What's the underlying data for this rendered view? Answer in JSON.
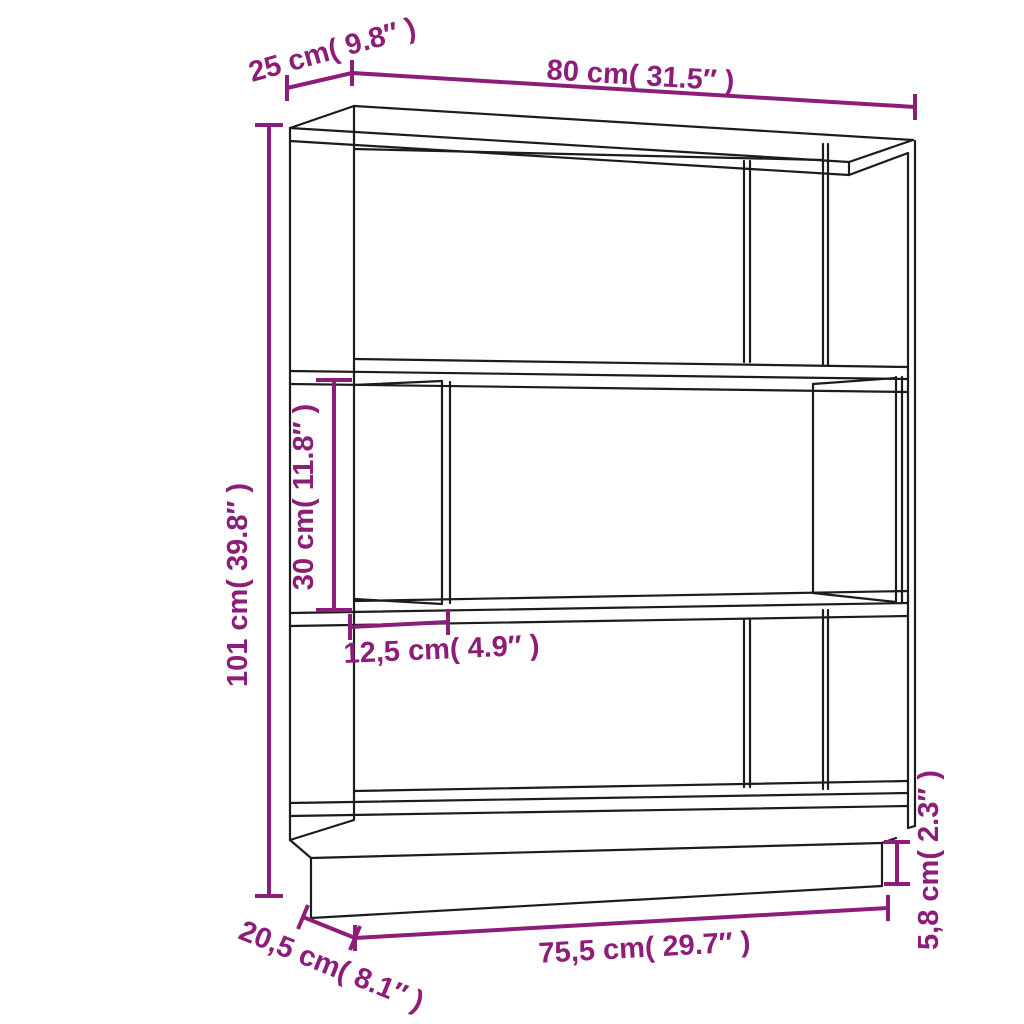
{
  "colors": {
    "dimension_accent": "#8C1D78",
    "line": "#1C1C1C",
    "background": "#FFFFFF"
  },
  "diagram": {
    "kind": "furniture-dimension-diagram",
    "object": "3-tier open bookshelf / room divider line drawing",
    "dimensions": {
      "top_depth": {
        "label": "25 cm( 9.8″ )"
      },
      "top_width": {
        "label": "80 cm( 31.5″ )"
      },
      "total_height": {
        "label": "101 cm( 39.8″ )"
      },
      "opening_height": {
        "label": "30 cm( 11.8″ )"
      },
      "compartment_width": {
        "label": "12,5 cm( 4.9″ )"
      },
      "base_width": {
        "label": "75,5 cm( 29.7″ )"
      },
      "base_depth": {
        "label": "20,5 cm( 8.1″ )"
      },
      "plinth_height": {
        "label": "5,8 cm( 2.3″ )"
      }
    }
  }
}
